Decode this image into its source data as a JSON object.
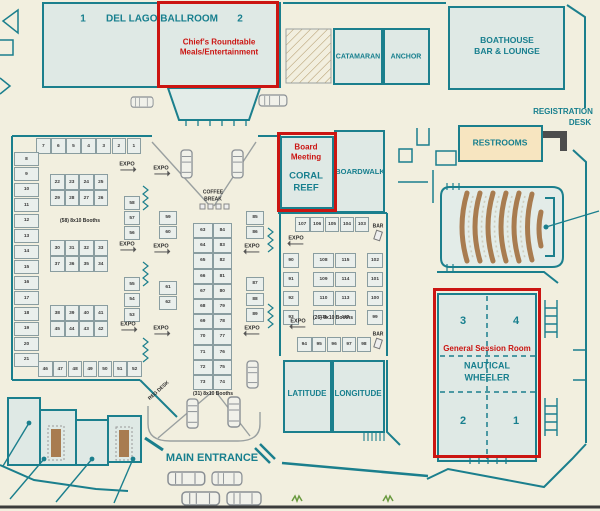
{
  "colors": {
    "teal": "#177f8e",
    "red": "#cb1512",
    "room_fill": "#dfe9e5",
    "background": "#f2efdf",
    "restrooms_tan": "#f7e5c0",
    "seating_brown": "#a87c50"
  },
  "rooms": {
    "del_lago": {
      "name": "DEL LAGO BALLROOM",
      "section_1": "1",
      "section_2": "2"
    },
    "chiefs": {
      "line1": "Chief's Roundtable",
      "line2": "Meals/Entertainment"
    },
    "catamaran": "CATAMARAN",
    "anchor": "ANCHOR",
    "boathouse": {
      "line1": "BOATHOUSE",
      "line2": "BAR & LOUNGE"
    },
    "registration": {
      "line1": "REGISTRATION",
      "line2": "DESK"
    },
    "restrooms": "RESTROOMS",
    "coral_reef": {
      "event_line1": "Board",
      "event_line2": "Meeting",
      "name_line1": "CORAL",
      "name_line2": "REEF"
    },
    "boardwalk": "BOARDWALK",
    "nautical": {
      "event": "General Session Room",
      "name_line1": "NAUTICAL",
      "name_line2": "WHEELER",
      "section_3": "3",
      "section_4": "4",
      "section_2": "2",
      "section_1": "1"
    },
    "latitude": "LATITUDE",
    "longitude": "LONGITUDE"
  },
  "expo": {
    "main_entrance": "MAIN ENTRANCE",
    "reg_desk": "REG DESK",
    "coffee_break": {
      "line1": "COFFEE",
      "line2": "BREAK"
    },
    "expo_label": "EXPO",
    "bar_label": "BAR",
    "group_labels": {
      "left": "(58) 8x10 Booths",
      "center": "(31) 8x10 Booths",
      "right": "(26) 8x10 Booths"
    },
    "booths": {
      "top_row": [
        "7",
        "6",
        "5",
        "4",
        "3",
        "2",
        "1"
      ],
      "left_col": [
        "8",
        "9",
        "10",
        "11",
        "12",
        "13",
        "14",
        "15",
        "16",
        "17",
        "18",
        "19",
        "20",
        "21"
      ],
      "block_a": [
        [
          "22",
          "23",
          "24",
          "25"
        ],
        [
          "29",
          "28",
          "27",
          "26"
        ]
      ],
      "block_b": [
        [
          "30",
          "31",
          "32",
          "33"
        ],
        [
          "37",
          "36",
          "35",
          "34"
        ]
      ],
      "block_c": [
        [
          "38",
          "39",
          "40",
          "41"
        ],
        [
          "45",
          "44",
          "43",
          "42"
        ]
      ],
      "bottom_row": [
        "46",
        "47",
        "48",
        "49",
        "50",
        "51",
        "52"
      ],
      "right_col_top": [
        "58",
        "57",
        "56"
      ],
      "right_col_bottom": [
        "55",
        "54",
        "53"
      ],
      "c_left_top": [
        "59",
        "60"
      ],
      "c_left_bottom": [
        "61",
        "62"
      ],
      "c_pairs": [
        [
          "63",
          "84"
        ],
        [
          "64",
          "83"
        ],
        [
          "65",
          "82"
        ],
        [
          "66",
          "81"
        ],
        [
          "67",
          "80"
        ],
        [
          "68",
          "79"
        ],
        [
          "69",
          "78"
        ],
        [
          "70",
          "77"
        ],
        [
          "71",
          "76"
        ],
        [
          "72",
          "75"
        ],
        [
          "73",
          "74"
        ]
      ],
      "c_right_top": [
        "85",
        "86"
      ],
      "c_right_bottom": [
        "87",
        "88",
        "89"
      ],
      "r_top_row": [
        "107",
        "106",
        "105",
        "104",
        "103"
      ],
      "r_left_col": [
        "90",
        "91",
        "92",
        "93"
      ],
      "r_block": [
        [
          "108",
          "115"
        ],
        [
          "109",
          "114"
        ],
        [
          "110",
          "113"
        ],
        [
          "111",
          "112"
        ]
      ],
      "r_right_col": [
        "102",
        "101",
        "100",
        "99"
      ],
      "r_bottom_row": [
        "94",
        "95",
        "96",
        "97",
        "98"
      ]
    }
  }
}
